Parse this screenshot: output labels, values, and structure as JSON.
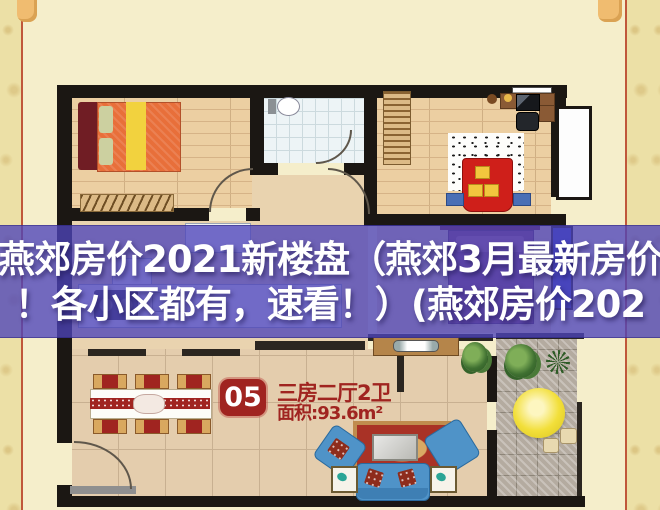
{
  "overlay": {
    "title_line_1": "燕郊房价2021新楼盘（燕郊3月最新房价",
    "title_line_2": "！各小区都有，速看！）(燕郊房价202",
    "text_color": "#ffffff",
    "band_color": "rgba(77,68,186,0.78)"
  },
  "floorplan_label": {
    "unit_number": "05",
    "unit_type": "三房二厅2卫",
    "unit_area": "面积:93.6m²",
    "accent_color": "#a02420"
  },
  "decor": {
    "background_color": "#f5eecb",
    "border_strip_color": "#ece0a6",
    "border_line_color": "#c0573b",
    "corner_ornament_color": "#f0bc70",
    "wall_color": "#1b1713"
  },
  "floorplan_icons": [
    "double-bed-icon",
    "pillow-icon",
    "radiator-rack-icon",
    "toilet-icon",
    "wardrobe-icon",
    "desk-icon",
    "computer-icon",
    "office-chair-icon",
    "futon-bed-icon",
    "speckled-rug-icon",
    "window-panel-icon",
    "kitchen-counter-icon",
    "stove-icon",
    "sink-icon",
    "bed2-icon",
    "dining-table-icon",
    "dining-chair-icon",
    "tv-stand-icon",
    "tv-icon",
    "area-rug-icon",
    "coffee-table-icon",
    "sofa-icon",
    "armchair-icon",
    "side-table-icon",
    "plant-icon",
    "parasol-icon",
    "stool-icon",
    "door-arc-icon",
    "entry-threshold-icon"
  ]
}
